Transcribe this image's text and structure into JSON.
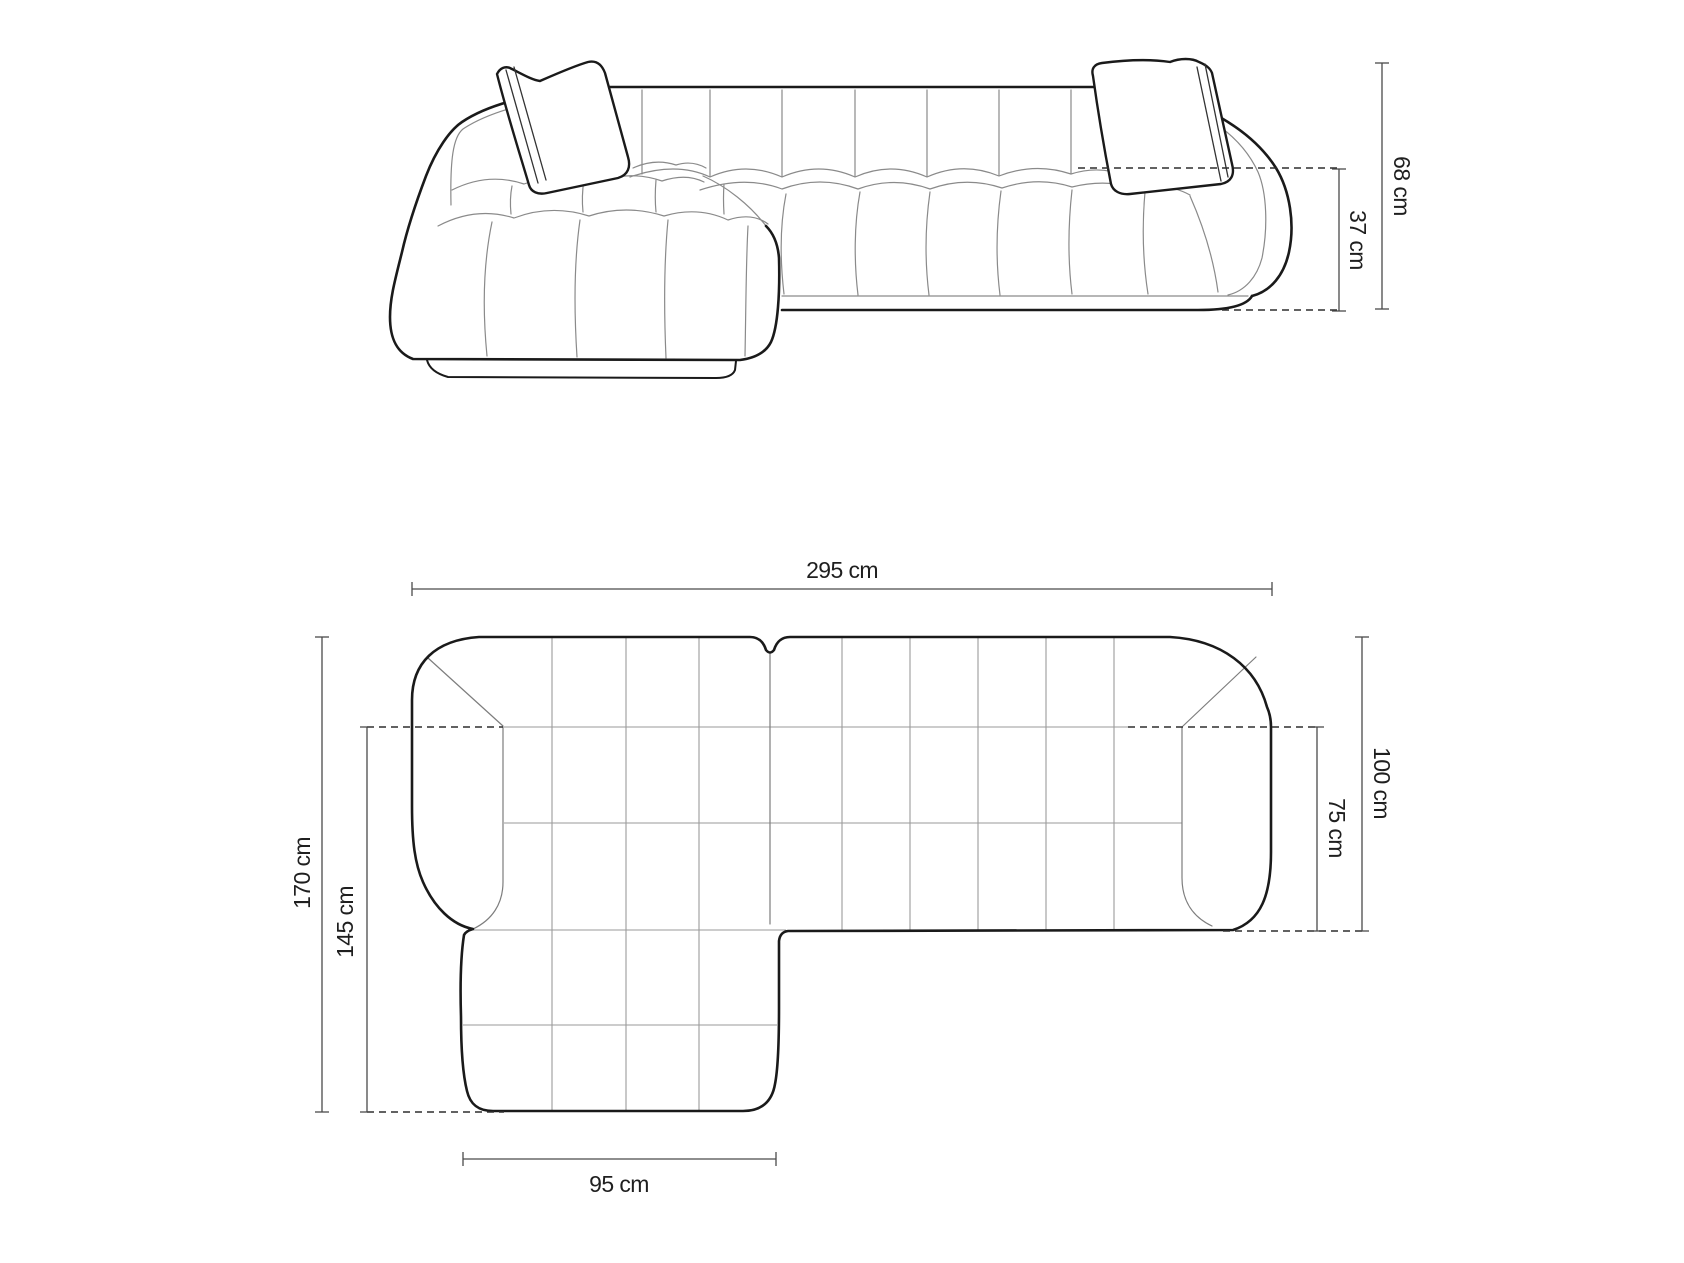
{
  "page": {
    "title": "Corner sofa dimensions diagram",
    "background": "#ffffff"
  },
  "palette": {
    "outline": "#1a1a1a",
    "detail_lines": "#8a8a8a",
    "grid_lines": "#9a9a9a",
    "dimension_lines": "#4a4a4a",
    "dashed_lines": "#2e2e2e",
    "text": "#1f1f1f"
  },
  "views": {
    "front": {
      "name": "front-elevation",
      "dimensions": [
        {
          "id": "total_height",
          "label": "68 cm",
          "orientation": "vertical"
        },
        {
          "id": "seat_height",
          "label": "37 cm",
          "orientation": "vertical"
        }
      ]
    },
    "plan": {
      "name": "top-plan",
      "dimensions": [
        {
          "id": "total_width",
          "label": "295 cm",
          "orientation": "horizontal"
        },
        {
          "id": "total_depth",
          "label": "100 cm",
          "orientation": "vertical"
        },
        {
          "id": "seat_depth",
          "label": "75 cm",
          "orientation": "vertical"
        },
        {
          "id": "chaise_length",
          "label": "170 cm",
          "orientation": "vertical"
        },
        {
          "id": "chaise_inner_length",
          "label": "145 cm",
          "orientation": "vertical"
        },
        {
          "id": "chaise_width",
          "label": "95 cm",
          "orientation": "horizontal"
        }
      ]
    }
  }
}
